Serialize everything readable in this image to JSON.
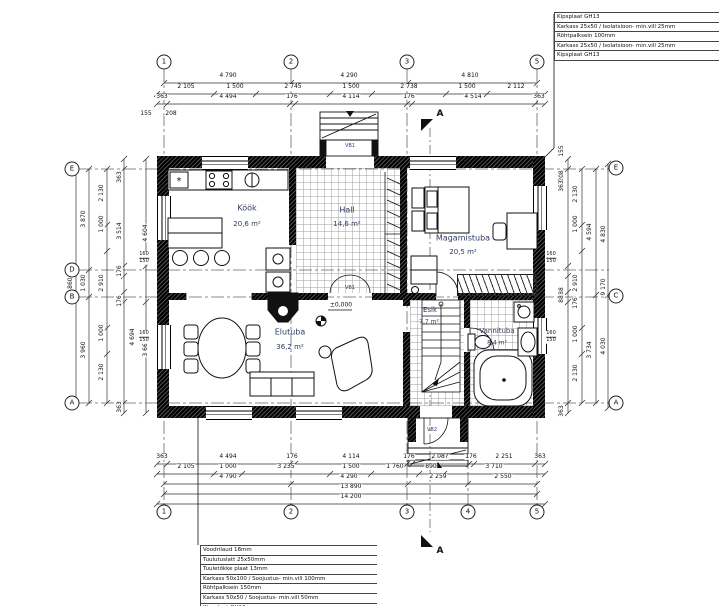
{
  "legend_top_right": [
    "Kipsplaat GH13",
    "Karkass 25x50 / Isolatsioon- min.vill 25mm",
    "Röhtpalksein 100mm",
    "Karkass 25x50 / Isolatsioon- min.vill 25mm",
    "Kipsplaat GH13"
  ],
  "legend_bottom_left": [
    "Voodrilaud 18mm",
    "Tuulutuslatt 25x50mm",
    "Tuuletõkke plaat 13mm",
    "Karkass 50x100 / Soojustus- min.vill 100mm",
    "Röhtpalksein 150mm",
    "Karkass 50x50 / Soojustus- min.vill 50mm",
    "Kipsplaat GH13"
  ],
  "grid": {
    "top": [
      "1",
      "2",
      "3",
      "5"
    ],
    "bottom": [
      "1",
      "2",
      "3",
      "4",
      "5"
    ],
    "left": [
      "E",
      "D",
      "B",
      "A"
    ],
    "right": [
      "E",
      "C",
      "A"
    ]
  },
  "rooms": [
    {
      "name": "Köök",
      "area": "20,6 m²"
    },
    {
      "name": "Hall",
      "area": "14,6 m²"
    },
    {
      "name": "Magamistuba",
      "area": "20,5 m²"
    },
    {
      "name": "Elutuba",
      "area": "36,2 m²"
    },
    {
      "name": "Esik",
      "area": "7,7 m²"
    },
    {
      "name": "Vannituba",
      "area": "8,4 m²"
    }
  ],
  "dims": {
    "top": {
      "row1": [
        "4 790",
        "4 290",
        "4 810"
      ],
      "row2": [
        "2 105",
        "1 500",
        "2 745",
        "1 500",
        "2 738",
        "1 500",
        "2 112"
      ],
      "row3": [
        "363",
        "4 494",
        "176",
        "4 114",
        "176",
        "4 514",
        "363"
      ],
      "misc": [
        "155",
        "208"
      ]
    },
    "bottom": {
      "row1": [
        "363",
        "4 494",
        "176",
        "4 114",
        "176",
        "2 087",
        "176",
        "2 251",
        "363"
      ],
      "row2": [
        "2 105",
        "1 000",
        "3 235",
        "1 500",
        "1 760",
        "890",
        "3 710"
      ],
      "row3": [
        "4 790",
        "4 290",
        "2 259",
        "2 550"
      ],
      "row4": [
        "13 890"
      ],
      "row5": [
        "14 200"
      ]
    },
    "left": {
      "col1": [
        "8 860"
      ],
      "col2": [
        "3 870",
        "1 030",
        "3 960"
      ],
      "col3": [
        "2 130",
        "1 000",
        "2 910",
        "1 000",
        "2 130"
      ],
      "col4": [
        "363",
        "3 514",
        "176",
        "176",
        "363"
      ],
      "col4b": [
        "4 694"
      ],
      "col5": [
        "4 604",
        "3 664"
      ]
    },
    "right": {
      "col1": [
        "155",
        "208",
        "363",
        "88",
        "88",
        "363"
      ],
      "col2": [
        "2 130",
        "1 000",
        "2 910",
        "176",
        "1 000",
        "2 130"
      ],
      "col3": [
        "4 594",
        "3 734"
      ],
      "col4": [
        "4 830",
        "9 170",
        "4 030"
      ]
    },
    "window_tag": [
      "160",
      "150"
    ]
  },
  "markers": {
    "section_label": "A",
    "level_label": "±0,000",
    "door_tags": {
      "entrance": "VB1",
      "hall": "VB1",
      "back": "VB2"
    }
  }
}
